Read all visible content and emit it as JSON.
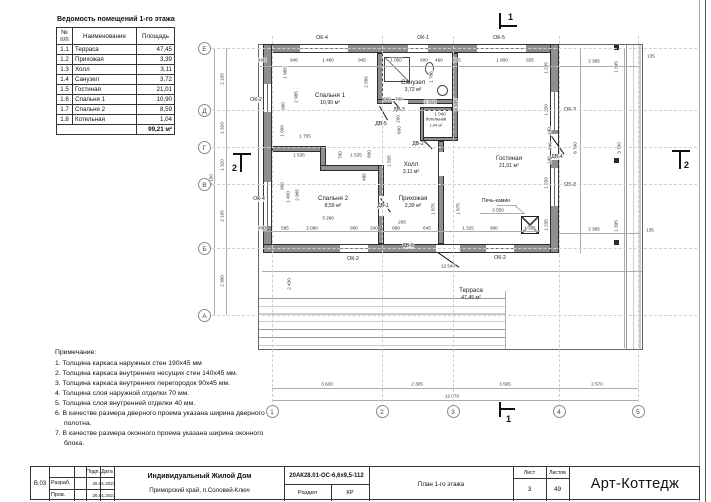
{
  "table": {
    "title": "Ведомость помещений 1-го этажа",
    "headers": [
      "№ п/п",
      "Наименование",
      "Площадь"
    ],
    "rows": [
      [
        "1.1",
        "Терраса",
        "47,45"
      ],
      [
        "1.2",
        "Прихожая",
        "3,39"
      ],
      [
        "1.3",
        "Холл",
        "3,11"
      ],
      [
        "1.4",
        "Санузел",
        "3,72"
      ],
      [
        "1.5",
        "Гостиная",
        "21,01"
      ],
      [
        "1.6",
        "Спальня 1",
        "10,90"
      ],
      [
        "1.7",
        "Спальня 2",
        "8,59"
      ],
      [
        "1.8",
        "Котельная",
        "1,04"
      ]
    ],
    "total": "99,21 м²"
  },
  "notes": {
    "title": "Примечание:",
    "items": [
      "1. Толщина каркаса наружных стен 190х45 мм",
      "2. Толщина каркаса внутренних несущих стен 140х45 мм.",
      "3. Толщина каркаса внутренних перегородок 90х45 мм.",
      "4. Толщина слоя наружной отделки 70 мм.",
      "5. Толщина слоя внутренней отделки 40 мм.",
      "6. В качестве размера дверного проема указана ширина дверного полотна.",
      "7. В качестве размера оконного проема указана ширина оконного блока."
    ]
  },
  "titleblock": {
    "code": "В.03",
    "row1_label": "Разраб.",
    "row2_label": "Пров.",
    "col_sign": "Подп.",
    "col_date": "Дата",
    "date1": "26.01.2021",
    "date2": "26.01.2021",
    "project": "Индивидуальный Жилой Дом",
    "location": "Приморский край, п.Соловей-Ключ",
    "doc_number": "20АК28.01-ОС-6,6х9,5-112",
    "section_label": "Раздел",
    "section_value": "КР",
    "sheet_name": "План 1-го этажа",
    "sheet_label": "Лист",
    "sheet_num": "3",
    "sheets_label": "Листов",
    "sheets_num": "49",
    "brand": "Арт-Коттедж"
  },
  "plan": {
    "stove_label": "Печь-камин",
    "rooms": [
      {
        "name": "Спальня 1",
        "area": "10,90 м²",
        "x": 330,
        "y": 99
      },
      {
        "name": "Санузел",
        "area": "3,72 м²",
        "x": 413,
        "y": 86
      },
      {
        "name": "Котельная",
        "area": "1,04 м²",
        "x": 436,
        "y": 122,
        "s": 1
      },
      {
        "name": "Холл",
        "area": "3,11 м²",
        "x": 411,
        "y": 168
      },
      {
        "name": "Прихожая",
        "area": "3,39 м²",
        "x": 413,
        "y": 202
      },
      {
        "name": "Спальня 2",
        "area": "8,59 м²",
        "x": 333,
        "y": 202
      },
      {
        "name": "Гостиная",
        "area": "21,01 м²",
        "x": 509,
        "y": 162
      },
      {
        "name": "Терраса",
        "area": "47,45 м²",
        "x": 471,
        "y": 294
      }
    ],
    "windows": [
      {
        "label": "ОК-4",
        "x": 322,
        "y": 38
      },
      {
        "label": "ОК-1",
        "x": 423,
        "y": 38
      },
      {
        "label": "ОК-5",
        "x": 499,
        "y": 38
      },
      {
        "label": "ОК-2",
        "x": 256,
        "y": 100
      },
      {
        "label": "ОК-4",
        "x": 259,
        "y": 199
      },
      {
        "label": "ОК-2",
        "x": 353,
        "y": 259
      },
      {
        "label": "ОК-2",
        "x": 500,
        "y": 258
      },
      {
        "label": "ОК-3",
        "x": 570,
        "y": 110
      },
      {
        "label": "ОК-3",
        "x": 570,
        "y": 185
      }
    ],
    "doors": [
      {
        "label": "ДВ-5",
        "x": 381,
        "y": 124
      },
      {
        "label": "ДВ-3",
        "x": 399,
        "y": 110
      },
      {
        "label": "ДВ-2",
        "x": 418,
        "y": 144
      },
      {
        "label": "ДВ-1",
        "x": 383,
        "y": 206
      },
      {
        "label": "ДВ-4",
        "x": 557,
        "y": 157
      },
      {
        "label": "ДВ-6",
        "x": 408,
        "y": 246
      }
    ],
    "axes_bottom": [
      {
        "label": "1",
        "x": 272
      },
      {
        "label": "2",
        "x": 382
      },
      {
        "label": "3",
        "x": 453
      },
      {
        "label": "4",
        "x": 559
      },
      {
        "label": "5",
        "x": 638
      }
    ],
    "axes_left": [
      {
        "label": "Е",
        "y": 48
      },
      {
        "label": "Д",
        "y": 110
      },
      {
        "label": "Г",
        "y": 147
      },
      {
        "label": "В",
        "y": 184
      },
      {
        "label": "Б",
        "y": 248
      },
      {
        "label": "А",
        "y": 315
      }
    ],
    "sections": [
      {
        "label": "1",
        "x": 508,
        "y": 12
      },
      {
        "label": "1",
        "x": 506,
        "y": 414
      },
      {
        "label": "2",
        "x": 232,
        "y": 163
      },
      {
        "label": "2",
        "x": 684,
        "y": 160
      }
    ],
    "dims": [
      {
        "t": "400",
        "x": 262,
        "y": 60
      },
      {
        "t": "945",
        "x": 294,
        "y": 60
      },
      {
        "t": "1 480",
        "x": 328,
        "y": 60
      },
      {
        "t": "945",
        "x": 362,
        "y": 60
      },
      {
        "t": "1 050",
        "x": 396,
        "y": 60
      },
      {
        "t": "600",
        "x": 424,
        "y": 60
      },
      {
        "t": "460",
        "x": 439,
        "y": 60
      },
      {
        "t": "825",
        "x": 457,
        "y": 60
      },
      {
        "t": "1 600",
        "x": 502,
        "y": 60
      },
      {
        "t": "825",
        "x": 530,
        "y": 60
      },
      {
        "t": "2 365",
        "x": 594,
        "y": 61
      },
      {
        "t": "135",
        "x": 651,
        "y": 56
      },
      {
        "t": "2 105",
        "x": 222,
        "y": 79,
        "r": 1
      },
      {
        "t": "1 320",
        "x": 222,
        "y": 128,
        "r": 1
      },
      {
        "t": "1 320",
        "x": 222,
        "y": 165,
        "r": 1
      },
      {
        "t": "2 105",
        "x": 222,
        "y": 216,
        "r": 1
      },
      {
        "t": "2 300",
        "x": 222,
        "y": 281,
        "r": 1
      },
      {
        "t": "9 150",
        "x": 211,
        "y": 180,
        "r": 1
      },
      {
        "t": "3 630",
        "x": 327,
        "y": 384
      },
      {
        "t": "2 305",
        "x": 417,
        "y": 384
      },
      {
        "t": "3 565",
        "x": 505,
        "y": 384
      },
      {
        "t": "2 570",
        "x": 597,
        "y": 384
      },
      {
        "t": "12 070",
        "x": 452,
        "y": 396
      },
      {
        "t": "12 540",
        "x": 448,
        "y": 266
      },
      {
        "t": "6 790",
        "x": 575,
        "y": 148,
        "r": 1
      },
      {
        "t": "3 730",
        "x": 619,
        "y": 148,
        "r": 1
      },
      {
        "t": "1 395",
        "x": 616,
        "y": 67,
        "r": 1
      },
      {
        "t": "1 395",
        "x": 616,
        "y": 226,
        "r": 1
      },
      {
        "t": "2 365",
        "x": 594,
        "y": 229
      },
      {
        "t": "135",
        "x": 650,
        "y": 230
      },
      {
        "t": "1 985",
        "x": 285,
        "y": 73,
        "r": 1
      },
      {
        "t": "2 985",
        "x": 296,
        "y": 97,
        "r": 1
      },
      {
        "t": "900",
        "x": 283,
        "y": 106,
        "r": 1
      },
      {
        "t": "2 085",
        "x": 366,
        "y": 82,
        "r": 1
      },
      {
        "t": "1 755",
        "x": 305,
        "y": 136
      },
      {
        "t": "1 535",
        "x": 299,
        "y": 155
      },
      {
        "t": "700",
        "x": 340,
        "y": 155,
        "r": 1
      },
      {
        "t": "1 535",
        "x": 356,
        "y": 155
      },
      {
        "t": "800",
        "x": 369,
        "y": 154,
        "r": 1
      },
      {
        "t": "1 505",
        "x": 389,
        "y": 161,
        "r": 1
      },
      {
        "t": "485",
        "x": 364,
        "y": 177,
        "r": 1
      },
      {
        "t": "1 400",
        "x": 288,
        "y": 197,
        "r": 1
      },
      {
        "t": "2 965",
        "x": 297,
        "y": 195,
        "r": 1
      },
      {
        "t": "900",
        "x": 282,
        "y": 186,
        "r": 1
      },
      {
        "t": "1 000",
        "x": 282,
        "y": 131,
        "r": 1
      },
      {
        "t": "3 290",
        "x": 328,
        "y": 218
      },
      {
        "t": "400",
        "x": 262,
        "y": 228
      },
      {
        "t": "585",
        "x": 285,
        "y": 228
      },
      {
        "t": "2 090",
        "x": 312,
        "y": 228
      },
      {
        "t": "900",
        "x": 354,
        "y": 228
      },
      {
        "t": "200",
        "x": 374,
        "y": 228
      },
      {
        "t": "968",
        "x": 396,
        "y": 228
      },
      {
        "t": "645",
        "x": 427,
        "y": 228
      },
      {
        "t": "205",
        "x": 402,
        "y": 222
      },
      {
        "t": "1 875",
        "x": 433,
        "y": 209,
        "r": 1
      },
      {
        "t": "1 875",
        "x": 458,
        "y": 209,
        "r": 1
      },
      {
        "t": "600",
        "x": 399,
        "y": 130,
        "r": 1
      },
      {
        "t": "200",
        "x": 398,
        "y": 119,
        "r": 1
      },
      {
        "t": "1 310",
        "x": 430,
        "y": 102
      },
      {
        "t": "1 040",
        "x": 440,
        "y": 114
      },
      {
        "t": "600",
        "x": 387,
        "y": 99
      },
      {
        "t": "700",
        "x": 399,
        "y": 99
      },
      {
        "t": "4 335",
        "x": 456,
        "y": 105,
        "r": 1
      },
      {
        "t": "1 766",
        "x": 431,
        "y": 77,
        "r": 1
      },
      {
        "t": "1 235",
        "x": 546,
        "y": 68,
        "r": 1
      },
      {
        "t": "1 250",
        "x": 546,
        "y": 110,
        "r": 1
      },
      {
        "t": "1 250",
        "x": 546,
        "y": 183,
        "r": 1
      },
      {
        "t": "1 235",
        "x": 546,
        "y": 225,
        "r": 1
      },
      {
        "t": "140",
        "x": 549,
        "y": 131,
        "r": 1
      },
      {
        "t": "840",
        "x": 550,
        "y": 146,
        "r": 1
      },
      {
        "t": "140",
        "x": 549,
        "y": 160,
        "r": 1
      },
      {
        "t": "3 550",
        "x": 498,
        "y": 210
      },
      {
        "t": "2 430",
        "x": 289,
        "y": 284,
        "r": 1
      },
      {
        "t": "1 325",
        "x": 468,
        "y": 228
      },
      {
        "t": "900",
        "x": 494,
        "y": 228
      },
      {
        "t": "1 325",
        "x": 530,
        "y": 228
      }
    ]
  }
}
